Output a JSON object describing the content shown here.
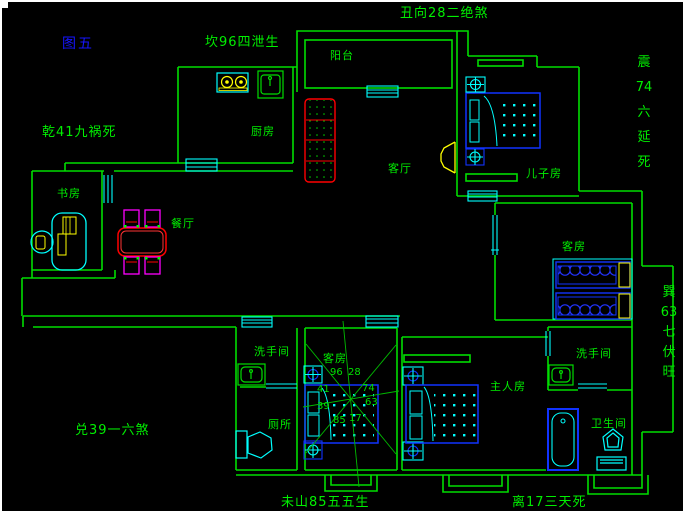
{
  "meta": {
    "figure_label": "图五"
  },
  "fengshui": {
    "kan": "坎96四泄生",
    "chou": "丑向28二绝煞",
    "qian": "乾41九祸死",
    "zhen": [
      "震",
      "74",
      "六",
      "延",
      "死"
    ],
    "dui": "兑39一六煞",
    "xun": [
      "巽",
      "63",
      "七",
      "伏",
      "旺"
    ],
    "wei": "未山85五五生",
    "li": "离17三天死"
  },
  "rooms": {
    "balcony": "阳台",
    "kitchen": "厨房",
    "living_room": "客厅",
    "sons_room": "儿子房",
    "study": "书房",
    "dining_room": "餐厅",
    "guest_room_right": "客房",
    "guest_room_center": "客房",
    "washroom_left": "洗手间",
    "toilet": "厕所",
    "master_room": "主人房",
    "washroom_right": "洗手间",
    "bathroom": "卫生间"
  },
  "compass": {
    "values": [
      "96",
      "28",
      "41",
      "74",
      "39",
      "63",
      "85",
      "17"
    ]
  },
  "colors": {
    "background": "#000000",
    "wall_green": "#00dd00",
    "text_green": "#00ee00",
    "window_cyan": "#00ffff",
    "furniture_blue": "#1133ff",
    "accent_yellow": "#ffff00",
    "accent_red": "#ff0000",
    "accent_magenta": "#ff00ff",
    "caption_blue": "#1515ff"
  }
}
